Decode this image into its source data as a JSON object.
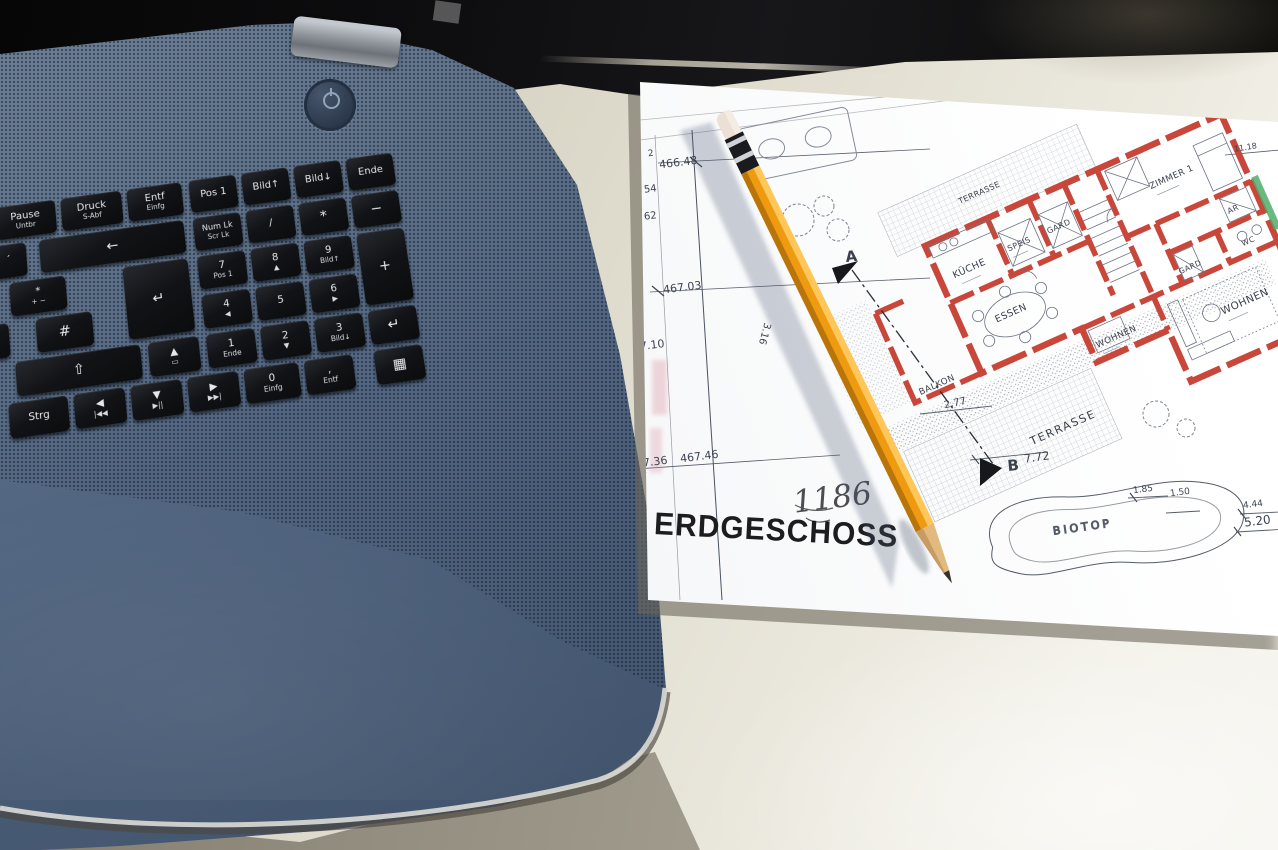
{
  "keyboard": {
    "keys": [
      {
        "label": "Pause",
        "sub": "Untbr"
      },
      {
        "label": "Druck",
        "sub": "S-Abf"
      },
      {
        "label": "Entf",
        "sub": "Einfg"
      },
      {
        "label": "Pos 1",
        "sub": ""
      },
      {
        "label": "Bild↑",
        "sub": ""
      },
      {
        "label": "Bild↓",
        "sub": ""
      },
      {
        "label": "Ende",
        "sub": ""
      },
      {
        "label": "´",
        "sub": ""
      },
      {
        "label": "←",
        "sub": ""
      },
      {
        "label": "Num Lk",
        "sub": "Scr Lk"
      },
      {
        "label": "/",
        "sub": ""
      },
      {
        "label": "*",
        "sub": ""
      },
      {
        "label": "−",
        "sub": ""
      },
      {
        "label": "*",
        "sub": "+ ~"
      },
      {
        "label": "↵",
        "sub": ""
      },
      {
        "label": "7",
        "sub": "Pos 1"
      },
      {
        "label": "8",
        "sub": "▲"
      },
      {
        "label": "9",
        "sub": "Bild↑"
      },
      {
        "label": "+",
        "sub": ""
      },
      {
        "label": "Ä",
        "sub": ""
      },
      {
        "label": "#",
        "sub": ""
      },
      {
        "label": "4",
        "sub": "◀"
      },
      {
        "label": "5",
        "sub": ""
      },
      {
        "label": "6",
        "sub": "▶"
      },
      {
        "label": "⇧",
        "sub": ""
      },
      {
        "label": "▲",
        "sub": "▭"
      },
      {
        "label": "1",
        "sub": "Ende"
      },
      {
        "label": "2",
        "sub": "▼"
      },
      {
        "label": "3",
        "sub": "Bild↓"
      },
      {
        "label": "↵",
        "sub": ""
      },
      {
        "label": "Strg",
        "sub": ""
      },
      {
        "label": "◀",
        "sub": "|◀◀"
      },
      {
        "label": "▼",
        "sub": "▶||"
      },
      {
        "label": "▶",
        "sub": "▶▶|"
      },
      {
        "label": "0",
        "sub": "Einfg"
      },
      {
        "label": ",",
        "sub": "Entf"
      },
      {
        "label": "▦",
        "sub": ""
      }
    ]
  },
  "plan": {
    "title": "ERDGESCHOSS",
    "handwritten": "1186",
    "rooms": [
      "KÜCHE",
      "SPEIS",
      "GARD",
      "ZIMMER 1",
      "ESSEN",
      "WOHNEN",
      "AR",
      "GARD",
      "WC",
      "WOHNEN",
      "BALKON",
      "TERRASSE",
      "TERRASSE",
      "BIOTOP"
    ],
    "markers": [
      "A",
      "B"
    ],
    "dims": [
      "2",
      "466.48",
      "54",
      "62",
      "467.03",
      "57.10",
      "3.16",
      "467.36",
      "467.46",
      "2.77",
      "7.72",
      "1.85",
      "1.50",
      "4.44",
      "5.20",
      "11.18"
    ]
  },
  "colors": {
    "laptop_deck": "#586b83",
    "key_black": "#0e1013",
    "paper_white": "#fbfbfb",
    "wall_red": "#c9463a",
    "pencil_orange": "#f09d15",
    "desk_cream": "#ddd9ca",
    "accent_green": "#4fae6b"
  }
}
